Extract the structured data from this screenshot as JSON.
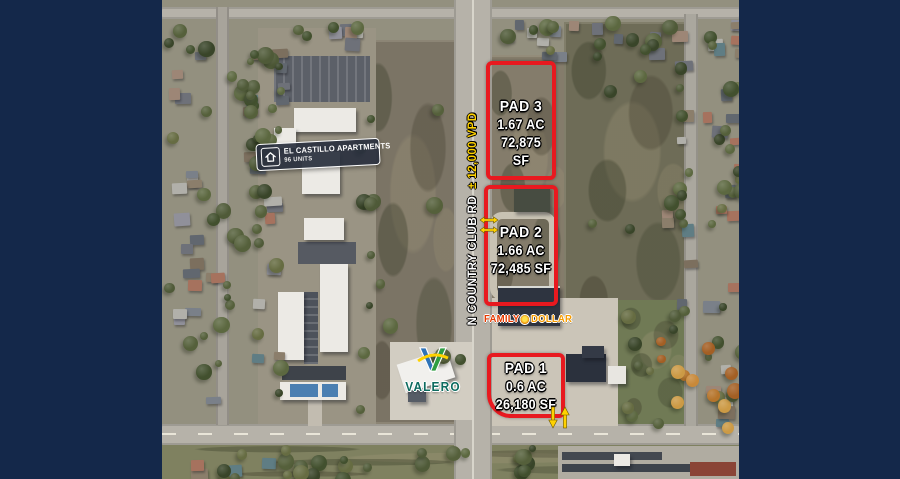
{
  "image": {
    "type": "aerial-site-plan",
    "colors": {
      "border_navy": "#14284a",
      "annotation_red": "#e8191f",
      "arrow_yellow": "#ffd200",
      "valero_teal": "#0c6b5f",
      "family_dollar_red": "#e63a00",
      "family_dollar_orange": "#f59b00"
    }
  },
  "pads": [
    {
      "label": "PAD 3",
      "area_acres": "1.67 AC",
      "area_sf": "72,875 SF"
    },
    {
      "label": "PAD 2",
      "area_acres": "1.66 AC",
      "area_sf": "72,485 SF"
    },
    {
      "label": "PAD 1",
      "area_acres": "0.6 AC",
      "area_sf": "26,180 SF"
    }
  ],
  "apartments_badge": {
    "title": "EL CASTILLO APARTMENTS",
    "subtitle": "96 UNITS"
  },
  "road_label": {
    "name": "N COUNTRY CLUB RD",
    "traffic": "± 12,000 VPD"
  },
  "brands": {
    "valero": {
      "wordmark": "VALERO"
    },
    "family_dollar": {
      "word1": "FAMILY",
      "word2": "DOLLAR"
    }
  }
}
